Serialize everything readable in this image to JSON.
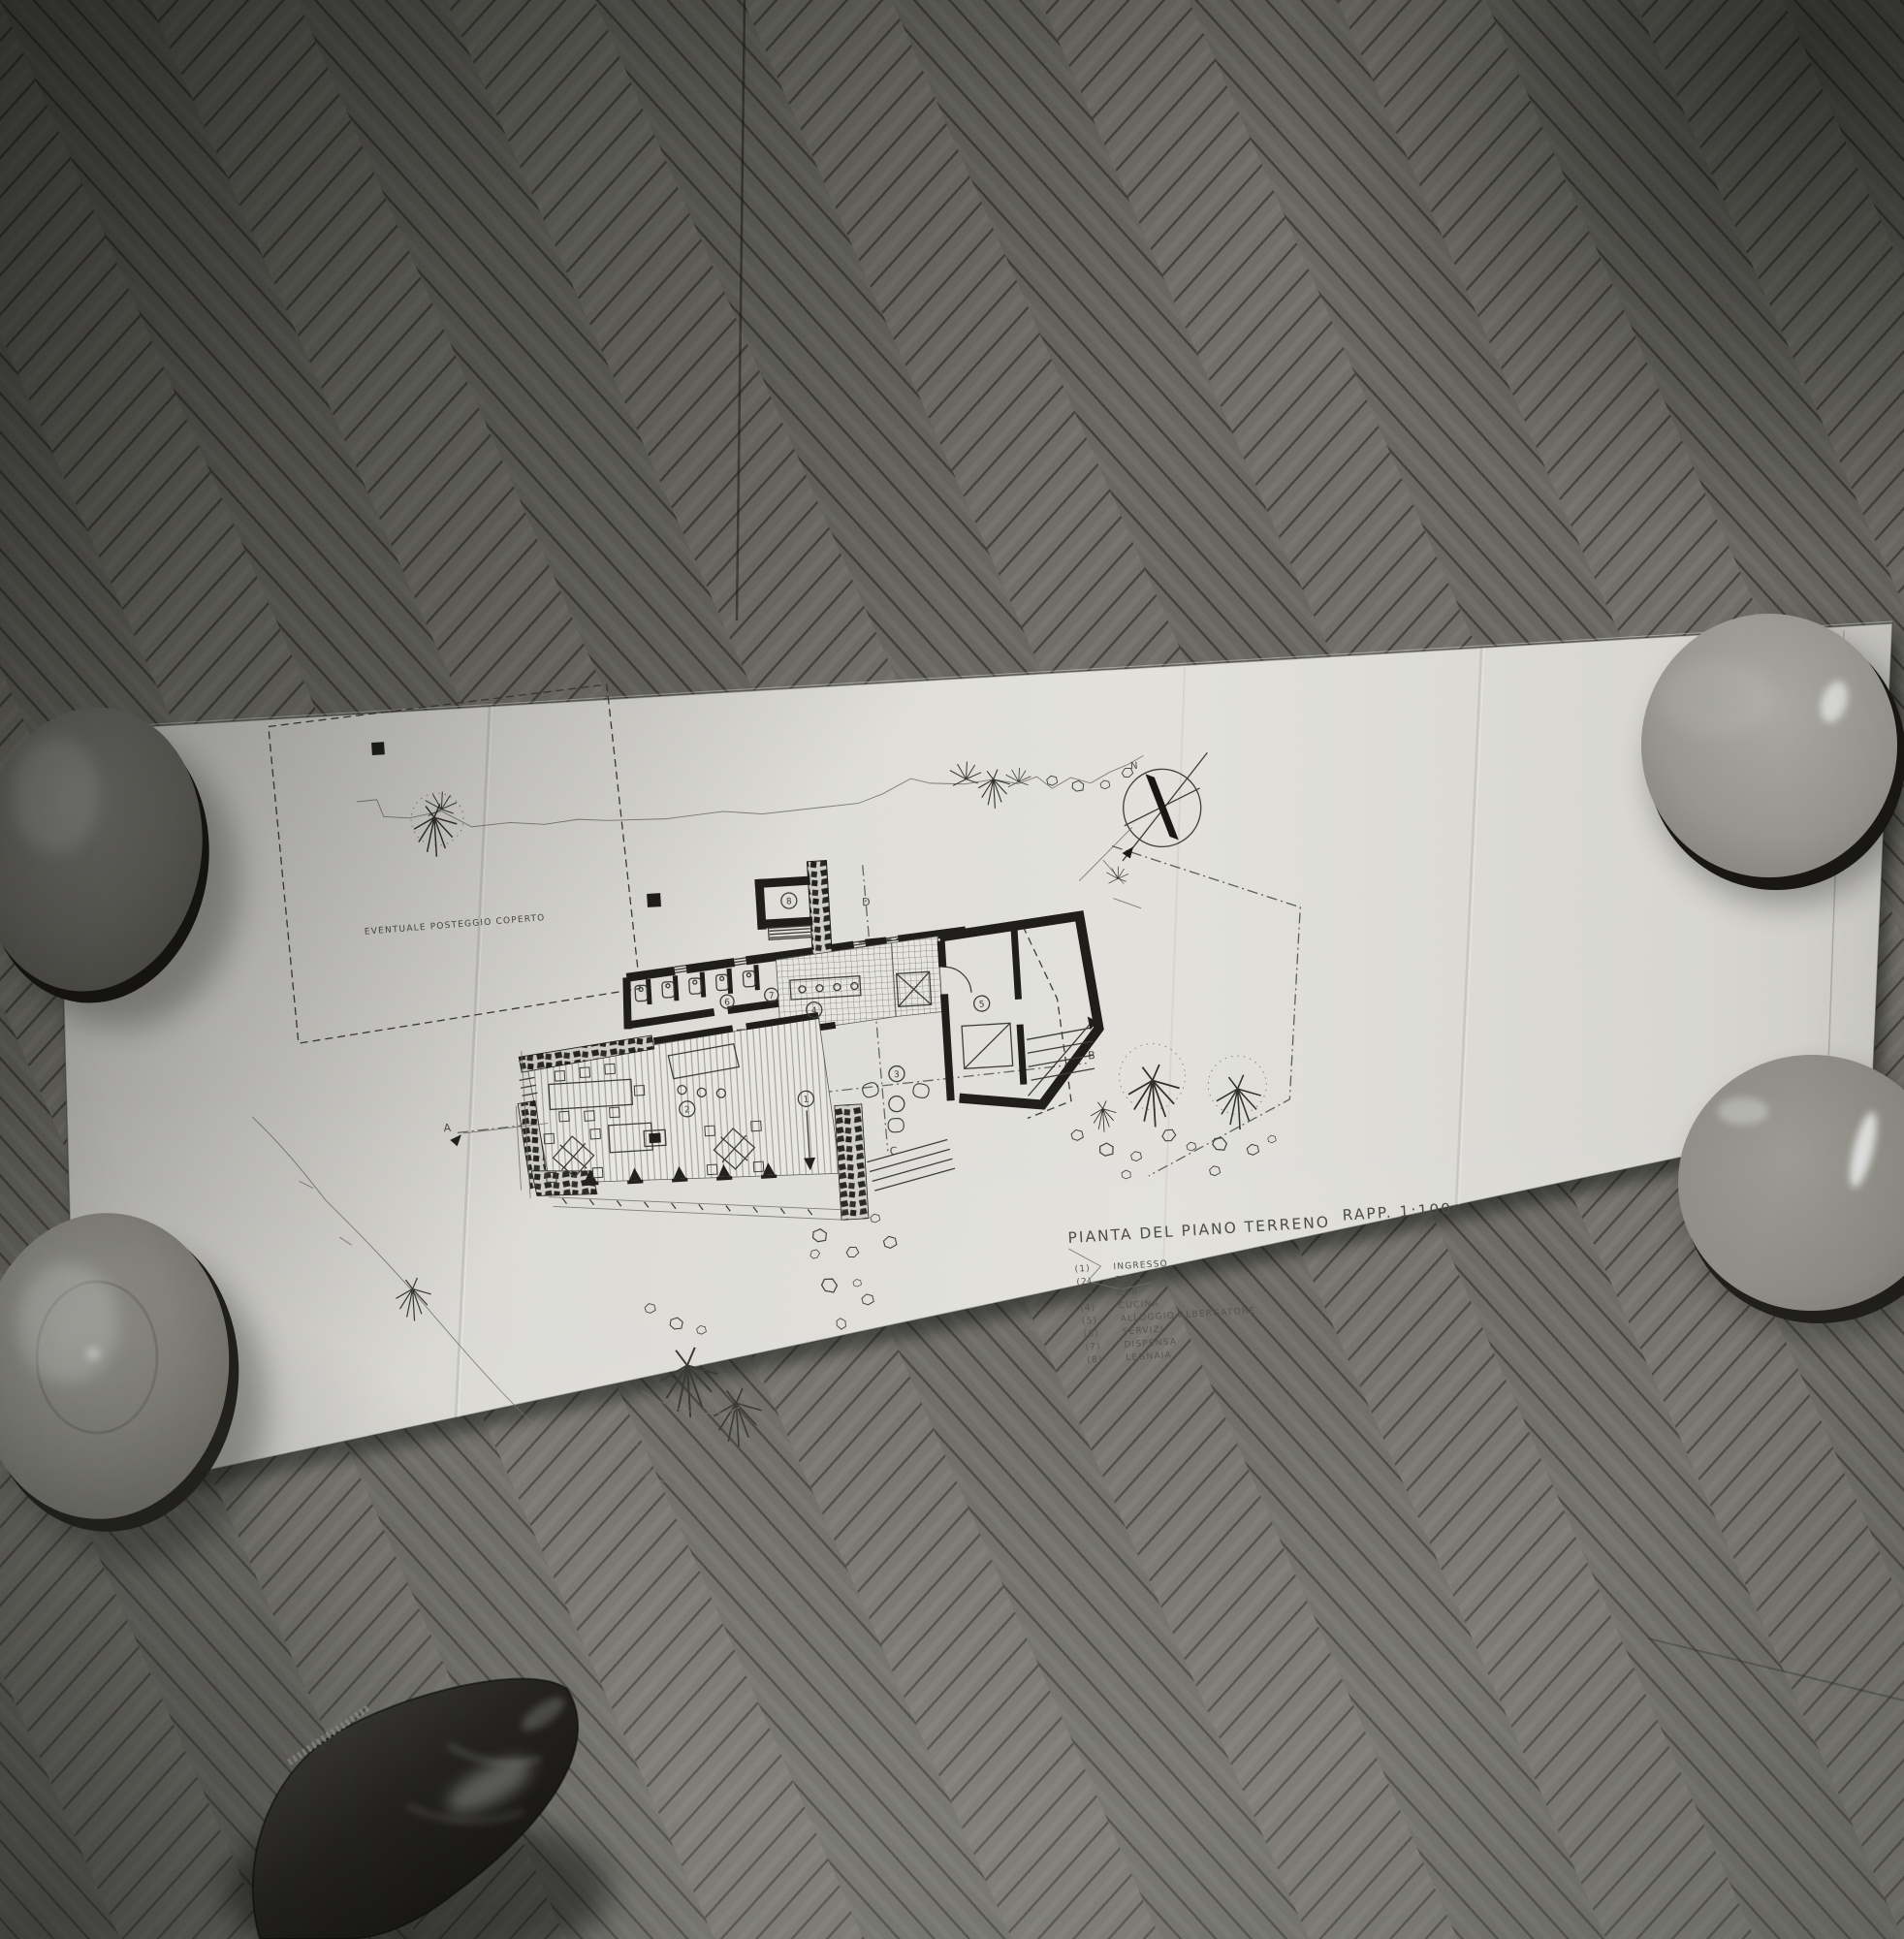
{
  "photo": {
    "type": "black-and-white photograph",
    "scene": "Unfolded architectural drawing lying on a herringbone parquet floor, its corners weighted by four round ceramic bowls; the photographer's shoe toe enters the frame at the bottom",
    "objects": {
      "paper": "folded drawing sheet",
      "floor": "herringbone parquet",
      "bowl_top_left": "dark ceramic bowl",
      "bowl_bottom_left": "ceramic bowl with soft highlight",
      "bowl_top_right": "light glossy ceramic bowl",
      "bowl_right_middle": "glossy ceramic bowl",
      "shoe": "black leather shoe toe"
    }
  },
  "drawing": {
    "title": "PIANTA DEL PIANO TERRENO",
    "scale_label": "RAPP. 1:100",
    "site_label": "EVENTUALE POSTEGGIO COPERTO",
    "compass": {
      "north_label": "N"
    },
    "section_markers": {
      "a": "A",
      "b": "B",
      "c": "C",
      "d": "D"
    },
    "room_numbers": [
      "1",
      "2",
      "3",
      "4",
      "5",
      "6",
      "7",
      "8"
    ],
    "legend": {
      "items": [
        {
          "num": "(1)",
          "label": "INGRESSO"
        },
        {
          "num": "(2)",
          "label": "SALA"
        },
        {
          "num": "(3)",
          "label": "BAR"
        },
        {
          "num": "(4)",
          "label": "CUCINA"
        },
        {
          "num": "(5)",
          "label": "ALLOGGIO ALBERGATORE"
        },
        {
          "num": "(6)",
          "label": "SERVIZI"
        },
        {
          "num": "(7)",
          "label": "DISPENSA"
        },
        {
          "num": "(8)",
          "label": "LEGNAIA"
        }
      ]
    }
  },
  "colors": {
    "floor_dark": "#3e3d39",
    "floor_mid": "#6e6d65",
    "floor_light": "#8e8c83",
    "paper": "#dad9d4",
    "ink": "#3a3934",
    "wall_ink": "#1b1a17",
    "bowl_grey": "#8f8e86",
    "shoe_black": "#121110"
  }
}
